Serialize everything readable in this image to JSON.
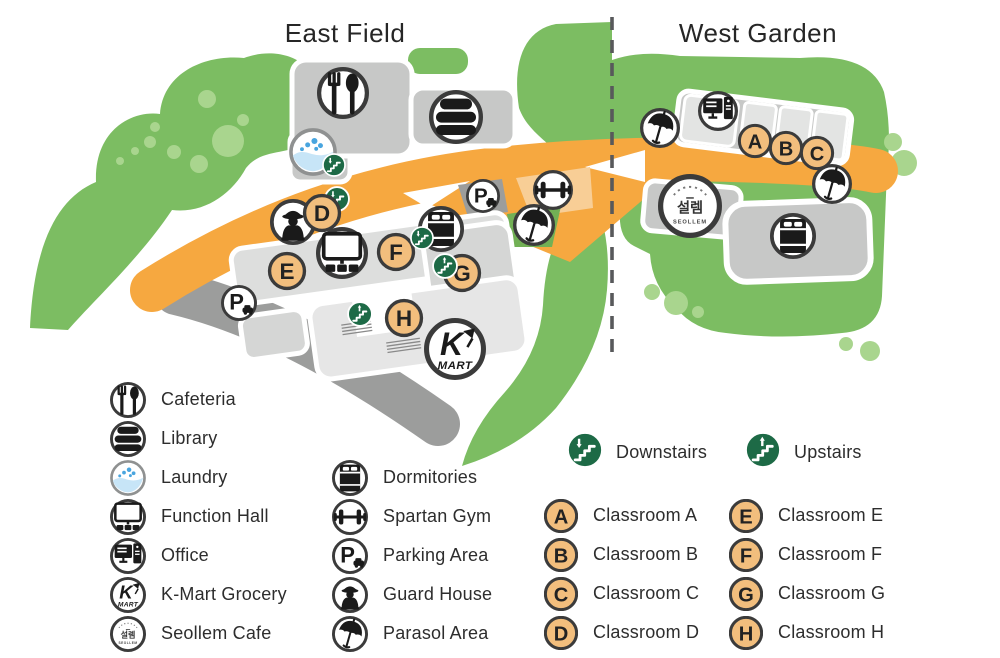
{
  "map": {
    "east_title": "East Field",
    "west_title": "West Garden",
    "kmart_text": {
      "k": "K",
      "mart": "MART"
    },
    "seollem_text": {
      "korean": "설렘",
      "roman": "SEOLLEM"
    },
    "colors": {
      "green": "#7CBD62",
      "light_green": "#A9D58E",
      "patch_green": "#72B055",
      "road": "#F6A840",
      "road_light": "#F8CE96",
      "building": "#C7C8C7",
      "building_mid": "#D5D6D5",
      "building_light": "#DDDEDD",
      "building_lighter": "#E6E6E6",
      "segment_light": "#E3E4E3",
      "strip_dark": "#9C9D9C",
      "stairs_green": "#1D6A46",
      "classroom_orange": "#F2BE7D",
      "divider": "#58595B",
      "ink": "#1a1a1a"
    },
    "markers": [
      {
        "icon": "cafeteria",
        "x": 343,
        "y": 93,
        "r": 26
      },
      {
        "icon": "library",
        "x": 456,
        "y": 117,
        "r": 27
      },
      {
        "icon": "laundry",
        "x": 313,
        "y": 152,
        "r": 24
      },
      {
        "icon": "downstairs",
        "x": 334,
        "y": 165,
        "r": 12
      },
      {
        "icon": "guard",
        "x": 293,
        "y": 222,
        "r": 23
      },
      {
        "icon": "downstairs",
        "x": 337,
        "y": 199,
        "r": 13
      },
      {
        "icon": "classroom",
        "letter": "D",
        "x": 322,
        "y": 213,
        "r": 19
      },
      {
        "icon": "function_hall",
        "x": 342,
        "y": 253,
        "r": 26
      },
      {
        "icon": "classroom",
        "letter": "E",
        "x": 287,
        "y": 271,
        "r": 19
      },
      {
        "icon": "classroom",
        "letter": "F",
        "x": 396,
        "y": 252,
        "r": 19
      },
      {
        "icon": "classroom",
        "letter": "G",
        "x": 462,
        "y": 273,
        "r": 19
      },
      {
        "icon": "upstairs",
        "x": 445,
        "y": 266,
        "r": 13
      },
      {
        "icon": "upstairs",
        "x": 360,
        "y": 314,
        "r": 13
      },
      {
        "icon": "classroom",
        "letter": "H",
        "x": 404,
        "y": 318,
        "r": 19
      },
      {
        "icon": "parking",
        "x": 239,
        "y": 303,
        "r": 18
      },
      {
        "icon": "parking",
        "x": 483,
        "y": 196,
        "r": 17
      },
      {
        "icon": "gym",
        "x": 553,
        "y": 190,
        "r": 20
      },
      {
        "icon": "parasol",
        "x": 534,
        "y": 225,
        "r": 21
      },
      {
        "icon": "dormitory",
        "x": 441,
        "y": 229,
        "r": 23
      },
      {
        "icon": "downstairs",
        "x": 422,
        "y": 238,
        "r": 12
      },
      {
        "icon": "kmart",
        "x": 455,
        "y": 349,
        "r": 31
      },
      {
        "icon": "office",
        "x": 718,
        "y": 111,
        "r": 20
      },
      {
        "icon": "parasol",
        "x": 660,
        "y": 128,
        "r": 20
      },
      {
        "icon": "classroom",
        "letter": "A",
        "x": 755,
        "y": 141,
        "r": 17
      },
      {
        "icon": "classroom",
        "letter": "B",
        "x": 786,
        "y": 148,
        "r": 17
      },
      {
        "icon": "classroom",
        "letter": "C",
        "x": 817,
        "y": 153,
        "r": 17
      },
      {
        "icon": "parasol",
        "x": 832,
        "y": 184,
        "r": 20
      },
      {
        "icon": "seollem",
        "x": 690,
        "y": 206,
        "r": 32
      },
      {
        "icon": "dormitory",
        "x": 793,
        "y": 236,
        "r": 23
      }
    ]
  },
  "legend": {
    "facilities_col1": [
      {
        "icon": "cafeteria",
        "label": "Cafeteria"
      },
      {
        "icon": "library",
        "label": "Library"
      },
      {
        "icon": "laundry",
        "label": "Laundry"
      },
      {
        "icon": "function_hall",
        "label": "Function Hall"
      },
      {
        "icon": "office",
        "label": "Office"
      },
      {
        "icon": "kmart",
        "label": "K-Mart Grocery"
      },
      {
        "icon": "seollem",
        "label": "Seollem Cafe"
      }
    ],
    "facilities_col2": [
      {
        "icon": "dormitory",
        "label": "Dormitories"
      },
      {
        "icon": "gym",
        "label": "Spartan Gym"
      },
      {
        "icon": "parking",
        "label": "Parking Area"
      },
      {
        "icon": "guard",
        "label": "Guard House"
      },
      {
        "icon": "parasol",
        "label": "Parasol Area"
      }
    ],
    "stairs": [
      {
        "icon": "downstairs",
        "label": "Downstairs"
      },
      {
        "icon": "upstairs",
        "label": "Upstairs"
      }
    ],
    "classrooms_col1": [
      {
        "letter": "A",
        "label": "Classroom A"
      },
      {
        "letter": "B",
        "label": "Classroom B"
      },
      {
        "letter": "C",
        "label": "Classroom C"
      },
      {
        "letter": "D",
        "label": "Classroom D"
      }
    ],
    "classrooms_col2": [
      {
        "letter": "E",
        "label": "Classroom E"
      },
      {
        "letter": "F",
        "label": "Classroom F"
      },
      {
        "letter": "G",
        "label": "Classroom G"
      },
      {
        "letter": "H",
        "label": "Classroom H"
      }
    ]
  }
}
